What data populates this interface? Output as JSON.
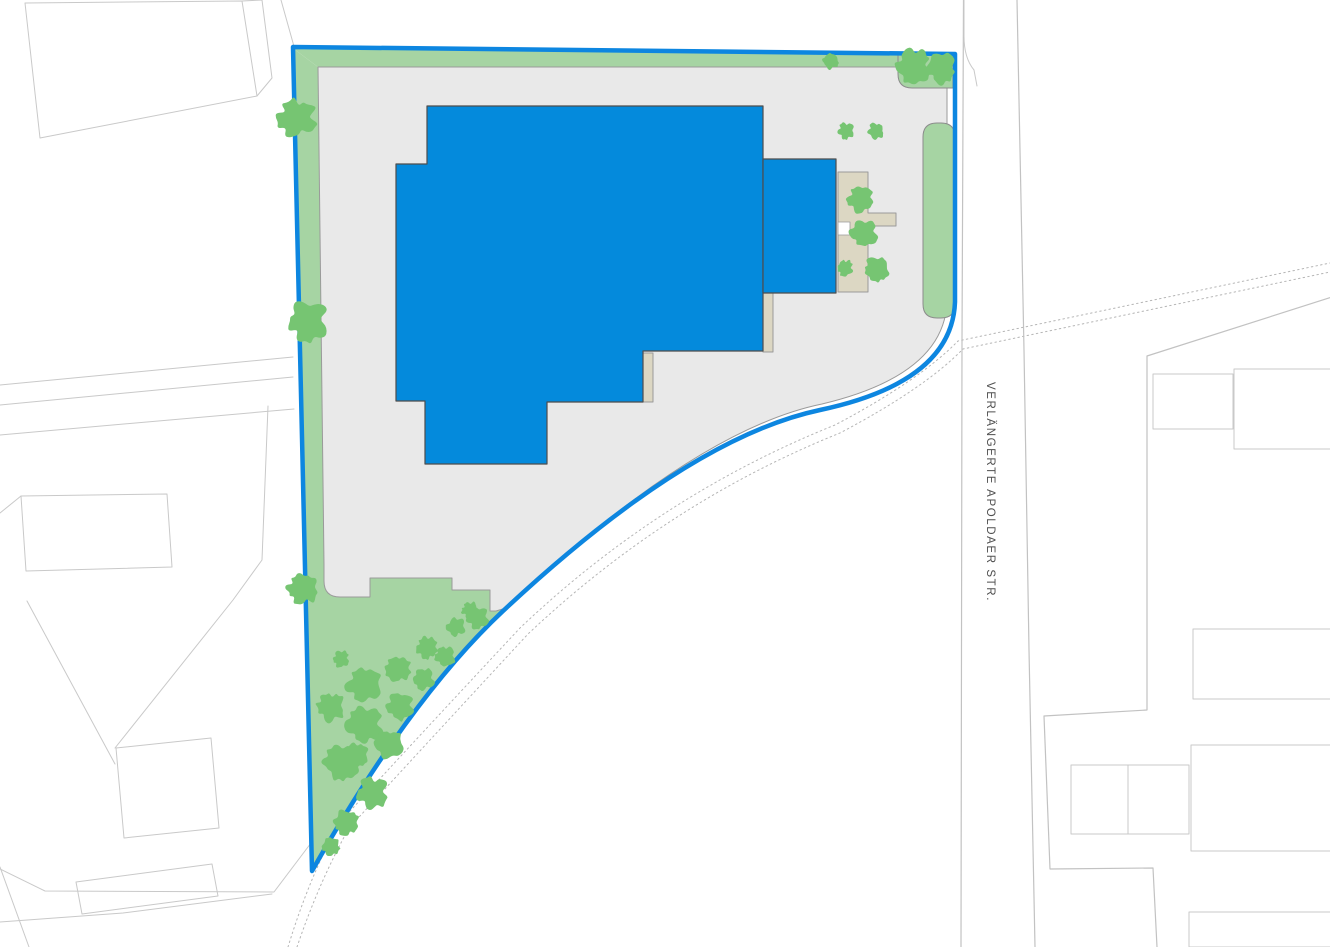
{
  "street": {
    "label": "VERLÄNGERTE APOLDAER STR.",
    "label_color": "#4f4f4f",
    "label_font_px": 11.5,
    "label_letter_spacing": 1.6,
    "label_x": 991,
    "label_y": 496,
    "label_rotate": 90
  },
  "colors": {
    "background": "#ffffff",
    "neighbor_line": "#c9c9c9",
    "dotted_line": "#b5b5b5",
    "street_edge": "#c2c2c2",
    "paving_fill": "#e9e9e9",
    "paving_stroke": "#9a9a9a",
    "green_fill": "#a6d4a3",
    "green_stroke": "#8c8c8c",
    "tree_fill": "#76c572",
    "tan_fill": "#dcd7c3",
    "tan_stroke": "#9a9a9a",
    "building_fill": "#048adc",
    "building_stroke": "#4d4d4d",
    "boundary_stroke": "#0d86e0"
  },
  "map": {
    "width": 1330,
    "height": 947,
    "layers": [
      {
        "name": "neighbors-west",
        "shapes": [
          {
            "name": "nw-building-1",
            "d": "M25,3 L242,1 L257,96 L40,138 Z",
            "fill": "none",
            "stroke": "#c9c9c9",
            "w": 1
          },
          {
            "name": "nw-building-2",
            "d": "M242,1 L262,0 L272,78 L257,96",
            "fill": "none",
            "stroke": "#c9c9c9",
            "w": 1
          },
          {
            "name": "w-road-line-1",
            "d": "M0,385 L293,357",
            "fill": "none",
            "stroke": "#c9c9c9",
            "w": 1
          },
          {
            "name": "w-road-line-2",
            "d": "M0,405 L293,377",
            "fill": "none",
            "stroke": "#c9c9c9",
            "w": 1
          },
          {
            "name": "w-road-line-3",
            "d": "M0,435 L294,409",
            "fill": "none",
            "stroke": "#c9c9c9",
            "w": 1
          },
          {
            "name": "w-parcel-chain",
            "d": "M268,406 L262,560 L233,600 L115,748",
            "fill": "none",
            "stroke": "#c9c9c9",
            "w": 1
          },
          {
            "name": "w-parcel-line",
            "d": "M27,601 L115,764",
            "fill": "none",
            "stroke": "#c9c9c9",
            "w": 1
          },
          {
            "name": "w-square-building",
            "d": "M116,748 L211,738 L219,828 L124,838 Z",
            "fill": "none",
            "stroke": "#c9c9c9",
            "w": 1
          },
          {
            "name": "w-line-short",
            "d": "M0,513 L21,496",
            "fill": "none",
            "stroke": "#c9c9c9",
            "w": 1
          },
          {
            "name": "w-building-mid",
            "d": "M21,496 L167,494 L172,567 L26,571 Z",
            "fill": "none",
            "stroke": "#c9c9c9",
            "w": 1
          },
          {
            "name": "w-bottom-line-1",
            "d": "M0,869 L45,891 L274,892 L311,843",
            "fill": "none",
            "stroke": "#c9c9c9",
            "w": 1
          },
          {
            "name": "w-bottom-line-2",
            "d": "M0,922 L123,913 L272,894",
            "fill": "none",
            "stroke": "#c9c9c9",
            "w": 1
          },
          {
            "name": "w-bottom-line-3",
            "d": "M0,867 L29,947",
            "fill": "none",
            "stroke": "#c9c9c9",
            "w": 1
          },
          {
            "name": "w-bottom-building",
            "d": "M76,882 L212,864 L218,896 L82,914 Z",
            "fill": "none",
            "stroke": "#c9c9c9",
            "w": 1
          },
          {
            "name": "nw-corner-line",
            "d": "M281,0 L295,50",
            "fill": "none",
            "stroke": "#c9c9c9",
            "w": 1
          }
        ]
      },
      {
        "name": "roads-dotted",
        "shapes": [
          {
            "name": "dotted-center-1",
            "d": "M288,947 Q310,875 340,822 Q420,735 520,628 Q660,495 835,425 Q920,380 958,341 L1330,263",
            "fill": "none",
            "stroke": "#b5b5b5",
            "w": 1,
            "dash": "1.5,3.2"
          },
          {
            "name": "dotted-center-2",
            "d": "M297,947 Q319,882 349,828 Q428,742 528,634 Q668,502 840,433 Q925,388 963,349 L1330,272",
            "fill": "none",
            "stroke": "#b5b5b5",
            "w": 1,
            "dash": "1.5,3.2"
          }
        ]
      },
      {
        "name": "street-lines",
        "shapes": [
          {
            "name": "street-west-edge",
            "d": "M963.5,0 L962,340 L961,947",
            "fill": "none",
            "stroke": "#c2c2c2",
            "w": 1.2
          },
          {
            "name": "street-corner-curve",
            "d": "M964,0 L964,36 Q964,58 974,70 L977,86",
            "fill": "none",
            "stroke": "#c9c9c9",
            "w": 1
          },
          {
            "name": "street-east-edge",
            "d": "M1017,0 L1024,350 L1029,650 L1035,947",
            "fill": "none",
            "stroke": "#c2c2c2",
            "w": 1.2
          },
          {
            "name": "e-parcel-chain",
            "d": "M1332,297 L1147,356 L1147,710 L1044,716 L1050,869 L1153,868 L1157,947",
            "fill": "none",
            "stroke": "#c2c2c2",
            "w": 1.2
          },
          {
            "name": "e-building-1",
            "d": "M1153,374 L1233,374 L1233,429 L1153,429 Z",
            "fill": "none",
            "stroke": "#c9c9c9",
            "w": 1
          },
          {
            "name": "e-building-2",
            "d": "M1234,369 L1332,369 L1332,449 L1234,449 Z",
            "fill": "none",
            "stroke": "#c9c9c9",
            "w": 1
          },
          {
            "name": "e-building-3",
            "d": "M1193,629 L1332,629 L1332,699 L1193,699 Z",
            "fill": "none",
            "stroke": "#c9c9c9",
            "w": 1
          },
          {
            "name": "e-building-4",
            "d": "M1191,745 L1332,745 L1332,851 L1191,851 Z",
            "fill": "none",
            "stroke": "#c9c9c9",
            "w": 1
          },
          {
            "name": "e-building-5",
            "d": "M1071,765 L1189,765 L1189,834 L1071,834 Z",
            "fill": "none",
            "stroke": "#c9c9c9",
            "w": 1
          },
          {
            "name": "e-building-5-divider",
            "d": "M1128,765 L1128,834",
            "fill": "none",
            "stroke": "#c9c9c9",
            "w": 1
          },
          {
            "name": "e-building-6",
            "d": "M1189,912 L1332,912 L1332,947 L1189,947 Z",
            "fill": "none",
            "stroke": "#c9c9c9",
            "w": 1
          }
        ]
      },
      {
        "name": "parcel",
        "shapes": [
          {
            "name": "parcel-base",
            "d": "M293,47 L955,54 L955,302 Q952,382 820,410 Q688,438 503,611 Q410,698 312,871 Z",
            "fill": "#ffffff",
            "stroke": "none",
            "w": 0
          },
          {
            "name": "green-top-strip",
            "d": "M294,49 L953,55 L953,67 L318,67 Z",
            "fill": "#a6d4a3",
            "stroke": "none",
            "w": 0
          },
          {
            "name": "green-left-and-triangle",
            "d": "M294,49 L318,67 L324,565 Q324,597 340,597 L370,597 L370,578 L452,578 L452,590 L490,590 L490,611 L506,608 Q410,700 312,871 Z",
            "fill": "#a6d4a3",
            "stroke": "none",
            "w": 0
          },
          {
            "name": "paving",
            "d": "M318,67 L947,67 L947,302 Q944,375 822,404 Q695,430 506,608 L496,611 L490,611 L490,590 L452,590 L452,578 L370,578 L370,597 L340,597 Q324,597 324,581 L324,565 L318,67 Z",
            "fill": "#e9e9e9",
            "stroke": "#9a9a9a",
            "w": 1
          },
          {
            "name": "green-corner-patch",
            "d": "M898,55 L953,55 L953,88 L912,88 Q898,88 898,74 Z",
            "fill": "#a6d4a3",
            "stroke": "#8c8c8c",
            "w": 1
          },
          {
            "name": "green-right-pill",
            "d": "M937,123 L941,123 Q955,123 955,137 L955,304 Q955,318 941,318 L937,318 Q923,318 923,304 L923,137 Q923,123 937,123 Z",
            "fill": "#a6d4a3",
            "stroke": "#8c8c8c",
            "w": 1
          }
        ]
      },
      {
        "name": "structures",
        "shapes": [
          {
            "name": "tan-sliver-right",
            "d": "M763,293 L773,293 L773,352 L763,352 Z",
            "fill": "#dcd7c3",
            "stroke": "#9a9a9a",
            "w": 1
          },
          {
            "name": "tan-sliver-step",
            "d": "M643,353 L653,353 L653,402 L643,402 Z",
            "fill": "#dcd7c3",
            "stroke": "#9a9a9a",
            "w": 1
          },
          {
            "name": "tan-terrace",
            "d": "M838,172 L868,172 L868,213 L896,213 L896,226 L868,226 L868,292 L838,292 Z",
            "fill": "#dcd7c3",
            "stroke": "#9a9a9a",
            "w": 1
          },
          {
            "name": "tan-terrace-notch",
            "d": "M838,222 L850,222 L850,235 L838,235 Z",
            "fill": "#ffffff",
            "stroke": "#9a9a9a",
            "w": 0.8
          },
          {
            "name": "main-building",
            "d": "M427,106 L763,106 L763,351 L643,351 L643,402 L547,402 L547,464 L425,464 L425,401 L396,401 L396,164 L427,164 Z",
            "fill": "#048adc",
            "stroke": "#4d4d4d",
            "w": 1.2
          },
          {
            "name": "building-annex",
            "d": "M763,159 L836,159 L836,293 L763,293 Z",
            "fill": "#048adc",
            "stroke": "#4d4d4d",
            "w": 1.2
          }
        ]
      },
      {
        "name": "boundary",
        "shapes": [
          {
            "name": "parcel-boundary",
            "d": "M293,47 L955,54 L955,302 Q952,382 820,410 Q688,438 503,611 Q410,698 312,871 Z",
            "fill": "none",
            "stroke": "#0d86e0",
            "w": 4.5
          }
        ]
      }
    ],
    "trees": [
      {
        "cx": 297,
        "cy": 118,
        "r": 21
      },
      {
        "cx": 308,
        "cy": 321,
        "r": 22
      },
      {
        "cx": 303,
        "cy": 589,
        "r": 17
      },
      {
        "cx": 831,
        "cy": 61,
        "r": 9
      },
      {
        "cx": 914,
        "cy": 67,
        "r": 19
      },
      {
        "cx": 941,
        "cy": 68,
        "r": 17
      },
      {
        "cx": 846,
        "cy": 131,
        "r": 9
      },
      {
        "cx": 876,
        "cy": 131,
        "r": 9
      },
      {
        "cx": 861,
        "cy": 199,
        "r": 15
      },
      {
        "cx": 864,
        "cy": 233,
        "r": 15
      },
      {
        "cx": 877,
        "cy": 270,
        "r": 14
      },
      {
        "cx": 845,
        "cy": 268,
        "r": 9
      },
      {
        "cx": 341,
        "cy": 659,
        "r": 9
      },
      {
        "cx": 427,
        "cy": 648,
        "r": 12
      },
      {
        "cx": 456,
        "cy": 627,
        "r": 10
      },
      {
        "cx": 470,
        "cy": 610,
        "r": 9
      },
      {
        "cx": 478,
        "cy": 618,
        "r": 12
      },
      {
        "cx": 364,
        "cy": 684,
        "r": 19
      },
      {
        "cx": 398,
        "cy": 669,
        "r": 15
      },
      {
        "cx": 331,
        "cy": 707,
        "r": 16
      },
      {
        "cx": 365,
        "cy": 725,
        "r": 20
      },
      {
        "cx": 400,
        "cy": 707,
        "r": 15
      },
      {
        "cx": 424,
        "cy": 679,
        "r": 12
      },
      {
        "cx": 445,
        "cy": 657,
        "r": 11
      },
      {
        "cx": 389,
        "cy": 744,
        "r": 16
      },
      {
        "cx": 356,
        "cy": 756,
        "r": 14
      },
      {
        "cx": 341,
        "cy": 763,
        "r": 19
      },
      {
        "cx": 373,
        "cy": 793,
        "r": 17
      },
      {
        "cx": 347,
        "cy": 823,
        "r": 14
      },
      {
        "cx": 331,
        "cy": 846,
        "r": 10
      }
    ]
  }
}
